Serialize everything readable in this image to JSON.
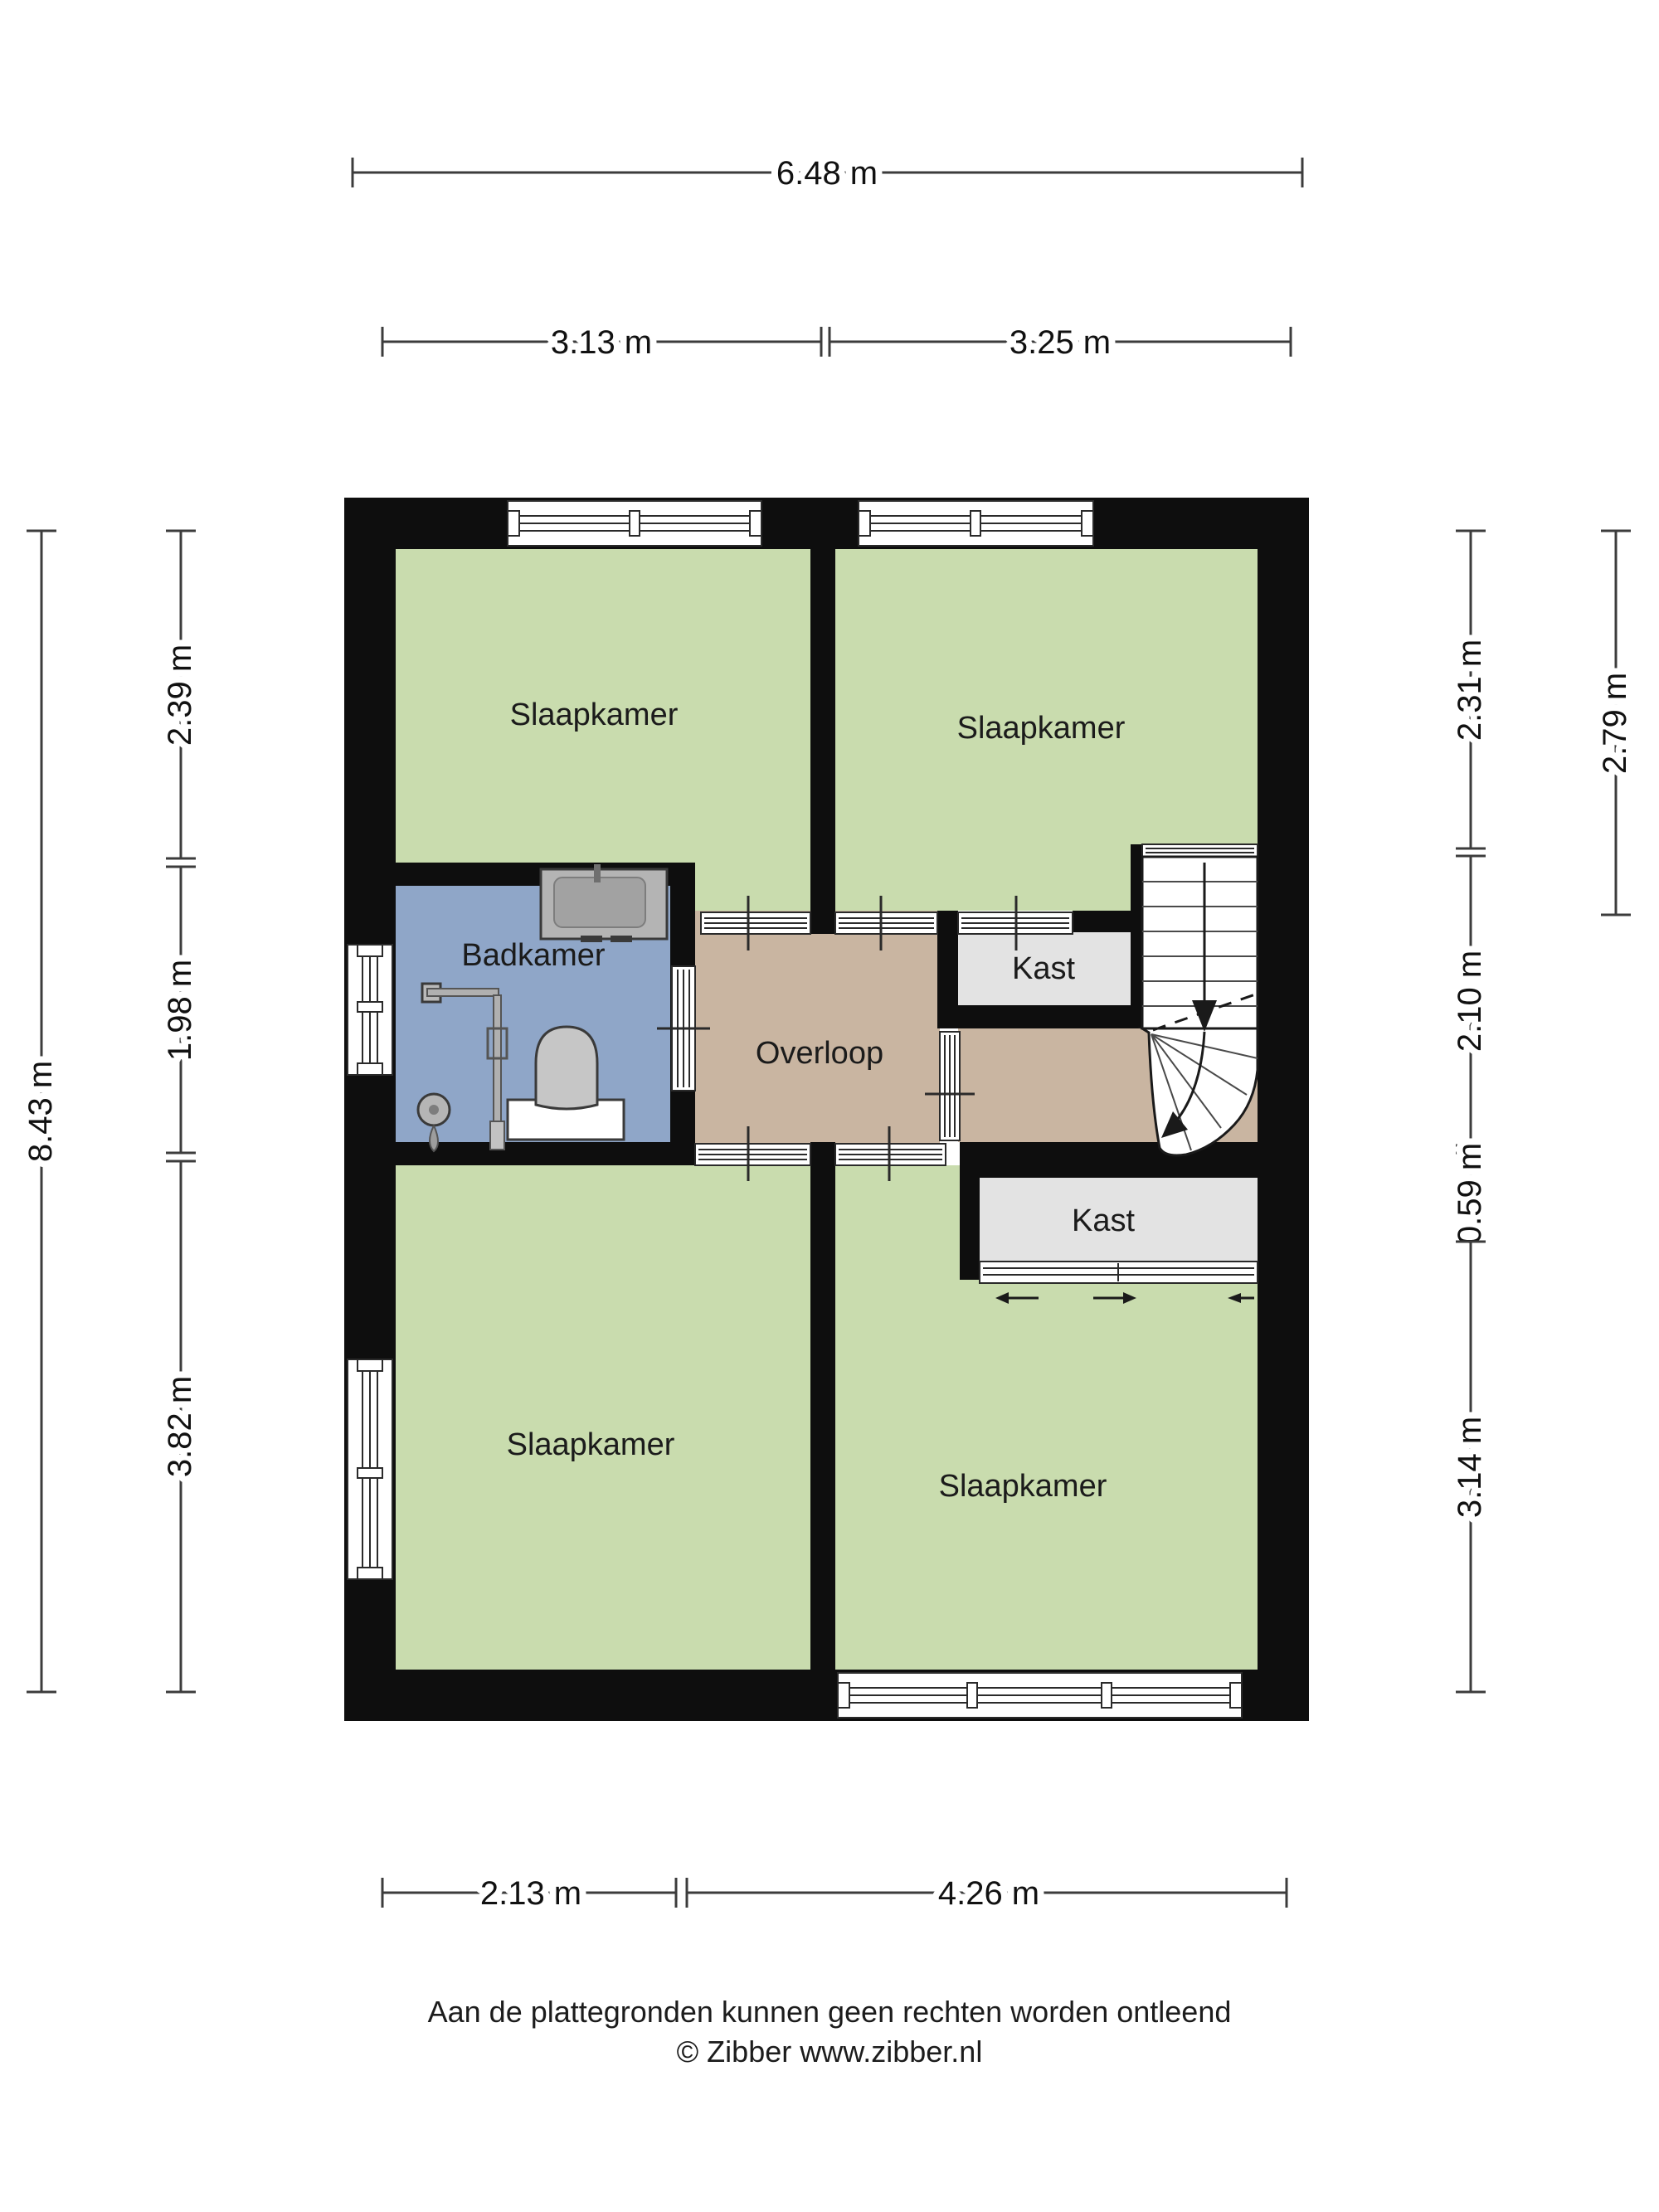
{
  "plan": {
    "title": "Verdieping plattegrond",
    "rooms": [
      {
        "id": "slaapkamer-linksboven",
        "label": "Slaapkamer"
      },
      {
        "id": "slaapkamer-rechtsboven",
        "label": "Slaapkamer"
      },
      {
        "id": "badkamer",
        "label": "Badkamer"
      },
      {
        "id": "overloop",
        "label": "Overloop"
      },
      {
        "id": "kast-boven",
        "label": "Kast"
      },
      {
        "id": "kast-onder",
        "label": "Kast"
      },
      {
        "id": "slaapkamer-linksonder",
        "label": "Slaapkamer"
      },
      {
        "id": "slaapkamer-rechtsonder",
        "label": "Slaapkamer"
      }
    ],
    "colors": {
      "bedroom": "#c9dcae",
      "bathroom": "#8fa6c8",
      "landing": "#c9b5a1",
      "closet": "#e3e3e3",
      "wall": "#0e0e0e"
    }
  },
  "dimensions": {
    "top_total": {
      "label": "6.48 m"
    },
    "top": [
      {
        "label": "3.13 m"
      },
      {
        "label": "3.25 m"
      }
    ],
    "bottom": [
      {
        "label": "2.13 m"
      },
      {
        "label": "4.26 m"
      }
    ],
    "left_total": {
      "label": "8.43 m"
    },
    "left": [
      {
        "label": "2.39 m"
      },
      {
        "label": "1.98 m"
      },
      {
        "label": "3.82 m"
      }
    ],
    "right": [
      {
        "label": "2.31 m"
      },
      {
        "label": "2.10 m"
      },
      {
        "label": "0.59 m"
      },
      {
        "label": "3.14 m"
      }
    ],
    "right_outer": {
      "label": "2.79 m"
    }
  },
  "footer": {
    "disclaimer": "Aan de plattegronden kunnen geen rechten worden ontleend",
    "credit": "© Zibber www.zibber.nl"
  }
}
